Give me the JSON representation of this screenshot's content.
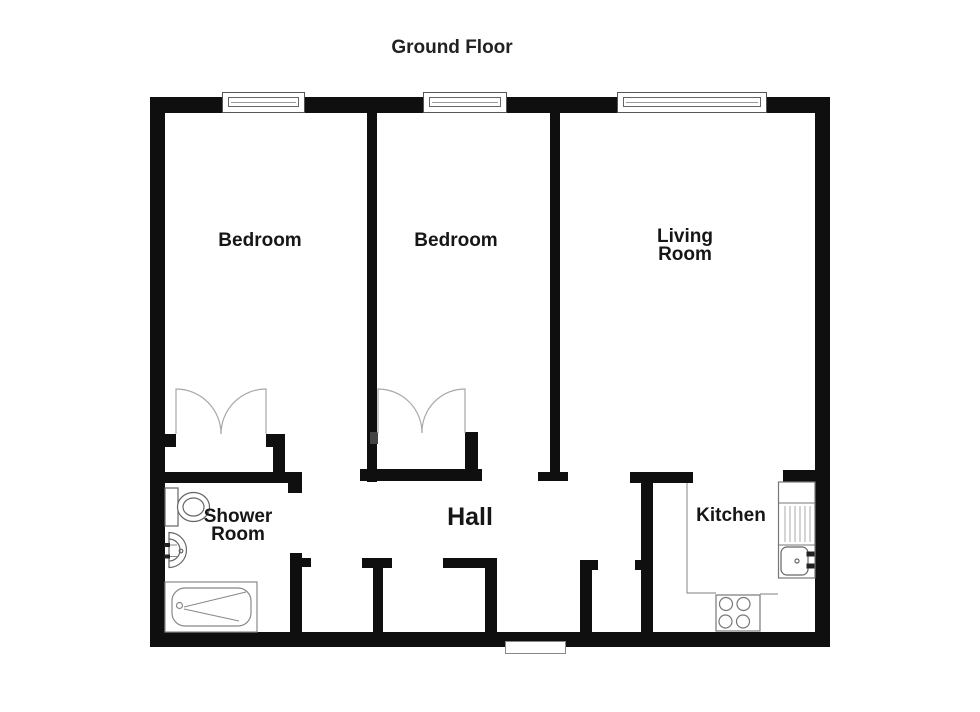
{
  "title": "Ground Floor",
  "colors": {
    "wall": "#0f0f0f",
    "background": "#ffffff",
    "door_swing": "#a8a8a8",
    "fixture_outline": "#777777"
  },
  "rooms": {
    "bedroom1": {
      "label": "Bedroom"
    },
    "bedroom2": {
      "label": "Bedroom"
    },
    "living_room": {
      "line1": "Living",
      "line2": "Room"
    },
    "hall": {
      "label": "Hall"
    },
    "shower_room": {
      "line1": "Shower",
      "line2": "Room"
    },
    "kitchen": {
      "label": "Kitchen"
    }
  },
  "windows": [
    "bedroom-1-window",
    "bedroom-2-window",
    "living-room-window"
  ],
  "fixtures": [
    "toilet",
    "wash-basin",
    "bathtub",
    "kitchen-sink-drainer",
    "stove-hob",
    "entrance-door",
    "wardrobe-double-doors-bedroom-1",
    "wardrobe-double-doors-bedroom-2"
  ]
}
